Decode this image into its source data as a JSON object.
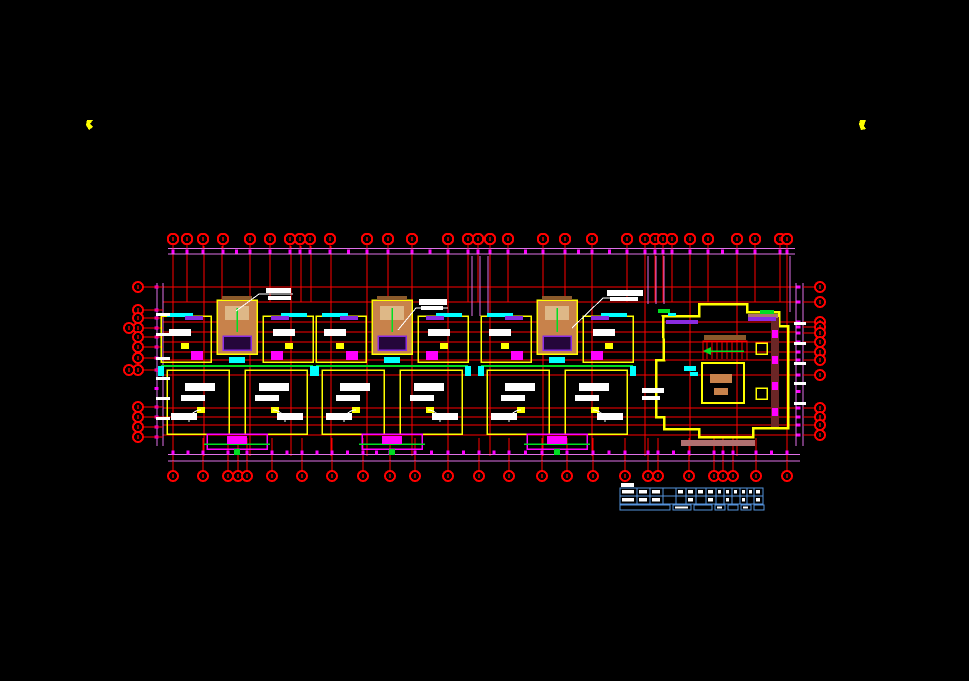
{
  "meta": {
    "width": 969,
    "height": 681,
    "background": "#000000",
    "drawing_type": "residential-floor-plan"
  },
  "colors": {
    "grid": "#ff0000",
    "grid_dark": "#aa0000",
    "dim": "#ff00ff",
    "dim2": "#e070e8",
    "wall": "#ffff00",
    "core": "#c8824b",
    "core2": "#deb887",
    "cyan": "#00ffff",
    "green": "#00dd22",
    "purple": "#8a2be2",
    "white": "#ffffff",
    "brown": "#8b5a2b",
    "rose": "#b07070",
    "darkred": "#6b2626",
    "table": "#5593dd",
    "black": "#000000"
  },
  "markers": [
    {
      "pts": [
        [
          87,
          120
        ],
        [
          93,
          120
        ],
        [
          90,
          124
        ],
        [
          93,
          127
        ],
        [
          89,
          130
        ],
        [
          86,
          125
        ]
      ]
    },
    {
      "pts": [
        [
          860,
          120
        ],
        [
          866,
          120
        ],
        [
          864,
          126
        ],
        [
          866,
          129
        ],
        [
          861,
          130
        ],
        [
          859,
          124
        ]
      ]
    }
  ],
  "top_chain": {
    "x1": 168,
    "x2": 795,
    "line_y": [
      248.5,
      254
    ],
    "tick_y": 249.5,
    "bubble_cy": 239,
    "bubble_r": 5.2,
    "bubbles_x": [
      173,
      187,
      203,
      223,
      250,
      270,
      290,
      300,
      310,
      330,
      367,
      388,
      412,
      448,
      468,
      478,
      490,
      508,
      543,
      565,
      592,
      627,
      645,
      655,
      663,
      672,
      690,
      708,
      737,
      755,
      780,
      787
    ]
  },
  "bottom_chain": {
    "x1": 168,
    "x2": 800,
    "line_y": [
      454.5,
      461
    ],
    "tick_y": 450.5,
    "bubble_cy": 476,
    "bubble_r": 5,
    "bubbles_x": [
      173,
      203,
      228,
      238,
      247,
      272,
      302,
      332,
      363,
      390,
      415,
      448,
      479,
      509,
      542,
      567,
      593,
      625,
      648,
      658,
      689,
      714,
      723,
      733,
      756,
      787
    ]
  },
  "left_chain": {
    "y1": 283,
    "y2": 446,
    "line_x": [
      157,
      163
    ],
    "tick_x": 154.5,
    "bubble_cx": 138,
    "bubble_r": 5,
    "bubbles_y": [
      287,
      310,
      318,
      328,
      337,
      347,
      358,
      370,
      407,
      417,
      427,
      437
    ],
    "double_y": [
      328,
      370
    ]
  },
  "right_chain": {
    "y1": 283,
    "y2": 446,
    "line_x": [
      796,
      803
    ],
    "tick_x": 796.5,
    "bubble_cx": 820,
    "bubble_r": 5,
    "bubbles_y": [
      287,
      302,
      322,
      327,
      333,
      342,
      352,
      360,
      375,
      408,
      417,
      425,
      435
    ],
    "double_y": []
  },
  "grid": {
    "verticals_full": [
      173,
      204,
      250,
      291,
      331,
      367,
      412,
      448,
      490,
      543,
      592,
      645,
      690,
      737,
      787
    ],
    "vert_y1": 246,
    "vert_y2": 456,
    "verticals_short": [
      187,
      222,
      270,
      301,
      311,
      388,
      468,
      478,
      508,
      565,
      627,
      655,
      663,
      672,
      708,
      755,
      780
    ],
    "short_y2": 302,
    "horizontal_x1": 163,
    "horizontal_x2": 800,
    "horizontals_y": [
      287,
      302,
      322,
      332,
      342,
      352,
      360,
      375,
      408,
      417,
      425,
      435
    ],
    "stem_y1": 438,
    "stem_y2": 471
  },
  "dim_stubs": [
    {
      "x": 472,
      "y1": 256,
      "y2": 316
    },
    {
      "x": 480,
      "y1": 256,
      "y2": 316
    },
    {
      "x": 488,
      "y1": 256,
      "y2": 316
    },
    {
      "x": 648,
      "y1": 256,
      "y2": 304
    },
    {
      "x": 656,
      "y1": 256,
      "y2": 304
    },
    {
      "x": 664,
      "y1": 256,
      "y2": 304
    },
    {
      "x": 790,
      "y1": 256,
      "y2": 312
    }
  ],
  "white_ticks": {
    "left": {
      "x": 156,
      "w": 14,
      "h": 3,
      "ys": [
        313,
        333,
        357,
        377,
        397,
        417
      ]
    },
    "right": {
      "x": 794,
      "w": 12,
      "h": 3,
      "ys": [
        322,
        342,
        362,
        382,
        402
      ]
    }
  },
  "units": {
    "centers": [
      237,
      392,
      557
    ],
    "prims": [
      {
        "t": "rect",
        "dx": -76,
        "y": 316,
        "w": 50,
        "h": 46,
        "s": "wall",
        "lw": 1.5
      },
      {
        "t": "rect",
        "dx": 26,
        "y": 316,
        "w": 50,
        "h": 46,
        "s": "wall",
        "lw": 1.5
      },
      {
        "t": "rect",
        "dx": -70,
        "y": 370,
        "w": 62,
        "h": 64,
        "s": "wall",
        "lw": 1.5
      },
      {
        "t": "rect",
        "dx": 8,
        "y": 370,
        "w": 62,
        "h": 64,
        "s": "wall",
        "lw": 1.5
      },
      {
        "t": "rect",
        "dx": -20,
        "y": 300,
        "w": 40,
        "h": 54,
        "f": "core",
        "s": "wall",
        "lw": 1.5
      },
      {
        "t": "rect",
        "dx": -12,
        "y": 306,
        "w": 24,
        "h": 14,
        "f": "core2"
      },
      {
        "t": "line",
        "x1d": 0,
        "y1": 308,
        "x2d": 0,
        "y2": 332,
        "s": "green",
        "lw": 1.5
      },
      {
        "t": "rect",
        "dx": -14,
        "y": 336,
        "w": 28,
        "h": 14,
        "f": "#24063a",
        "s": "purple",
        "lw": 1.5
      },
      {
        "t": "rect",
        "dx": -15,
        "y": 296,
        "w": 30,
        "h": 4,
        "f": "brown"
      },
      {
        "t": "rect",
        "dx": -70,
        "y": 313,
        "w": 26,
        "h": 4,
        "f": "cyan"
      },
      {
        "t": "rect",
        "dx": 44,
        "y": 313,
        "w": 26,
        "h": 4,
        "f": "cyan"
      },
      {
        "t": "rect",
        "dx": -52,
        "y": 316,
        "w": 18,
        "h": 4,
        "f": "purple"
      },
      {
        "t": "rect",
        "dx": 34,
        "y": 316,
        "w": 18,
        "h": 4,
        "f": "purple"
      },
      {
        "t": "rect",
        "dx": -68,
        "y": 329,
        "w": 22,
        "h": 7,
        "f": "white"
      },
      {
        "t": "rect",
        "dx": 36,
        "y": 329,
        "w": 22,
        "h": 7,
        "f": "white"
      },
      {
        "t": "rect",
        "dx": -56,
        "y": 343,
        "w": 8,
        "h": 6,
        "f": "wall"
      },
      {
        "t": "rect",
        "dx": 48,
        "y": 343,
        "w": 8,
        "h": 6,
        "f": "wall"
      },
      {
        "t": "rect",
        "dx": -46,
        "y": 351,
        "w": 12,
        "h": 9,
        "f": "dim"
      },
      {
        "t": "rect",
        "dx": 34,
        "y": 351,
        "w": 12,
        "h": 9,
        "f": "dim"
      },
      {
        "t": "line",
        "x1d": -76,
        "y1": 366,
        "x2d": 76,
        "y2": 366,
        "s": "green",
        "lw": 2
      },
      {
        "t": "rect",
        "dx": -8,
        "y": 357,
        "w": 16,
        "h": 6,
        "f": "cyan"
      },
      {
        "t": "rect",
        "dx": -52,
        "y": 383,
        "w": 30,
        "h": 8,
        "f": "white"
      },
      {
        "t": "rect",
        "dx": -56,
        "y": 395,
        "w": 24,
        "h": 6,
        "f": "white"
      },
      {
        "t": "rect",
        "dx": 22,
        "y": 383,
        "w": 30,
        "h": 8,
        "f": "white"
      },
      {
        "t": "rect",
        "dx": 18,
        "y": 395,
        "w": 24,
        "h": 6,
        "f": "white"
      },
      {
        "t": "rect",
        "dx": -40,
        "y": 407,
        "w": 8,
        "h": 6,
        "f": "wall"
      },
      {
        "t": "rect",
        "dx": 34,
        "y": 407,
        "w": 8,
        "h": 6,
        "f": "wall"
      },
      {
        "t": "rect",
        "dx": -66,
        "y": 413,
        "w": 26,
        "h": 7,
        "f": "white"
      },
      {
        "t": "rect",
        "dx": 40,
        "y": 413,
        "w": 26,
        "h": 7,
        "f": "white"
      },
      {
        "t": "rect",
        "dx": -30,
        "y": 434,
        "w": 60,
        "h": 15,
        "s": "dim",
        "lw": 1.5
      },
      {
        "t": "line",
        "x1d": -33,
        "y1": 444,
        "x2d": 33,
        "y2": 444,
        "s": "green",
        "lw": 1.5
      },
      {
        "t": "rect",
        "dx": -10,
        "y": 436,
        "w": 20,
        "h": 8,
        "f": "dim"
      },
      {
        "t": "rect",
        "dx": -3,
        "y": 449,
        "w": 6,
        "h": 6,
        "f": "green"
      },
      {
        "t": "rect",
        "dx": -79,
        "y": 366,
        "w": 6,
        "h": 10,
        "f": "cyan"
      },
      {
        "t": "rect",
        "dx": 73,
        "y": 366,
        "w": 6,
        "h": 10,
        "f": "cyan"
      },
      {
        "t": "arc",
        "dx": -36,
        "y": 422,
        "r": 12,
        "dir": 1
      },
      {
        "t": "arc",
        "dx": 36,
        "y": 422,
        "r": 12,
        "dir": -1
      }
    ]
  },
  "right_room": {
    "outline": [
      [
        663,
        316
      ],
      [
        699,
        316
      ],
      [
        699,
        304
      ],
      [
        747,
        304
      ],
      [
        747,
        312
      ],
      [
        779,
        312
      ],
      [
        779,
        326
      ],
      [
        788,
        326
      ],
      [
        788,
        428
      ],
      [
        753,
        428
      ],
      [
        753,
        437
      ],
      [
        699,
        437
      ],
      [
        699,
        429
      ],
      [
        664,
        429
      ],
      [
        664,
        417
      ],
      [
        656,
        417
      ],
      [
        656,
        360
      ],
      [
        664,
        360
      ]
    ],
    "outline_lw": 2.5,
    "prims": [
      {
        "t": "rect",
        "x": 704,
        "y": 335,
        "w": 42,
        "h": 5,
        "f": "brown"
      },
      {
        "t": "rect",
        "x": 703,
        "y": 341,
        "w": 44,
        "h": 19,
        "s": "grid",
        "lw": 1
      },
      {
        "t": "hatchv",
        "x": 707,
        "y": 342,
        "w": 38,
        "h": 17,
        "step": 5,
        "s": "grid"
      },
      {
        "t": "line",
        "x1": 708,
        "y1": 351,
        "x2": 744,
        "y2": 351,
        "s": "green",
        "lw": 1.5
      },
      {
        "t": "poly",
        "pts": [
          [
            703,
            351
          ],
          [
            711,
            347
          ],
          [
            711,
            355
          ]
        ],
        "f": "green"
      },
      {
        "t": "rect",
        "x": 702,
        "y": 363,
        "w": 42,
        "h": 40,
        "s": "wall",
        "lw": 2
      },
      {
        "t": "rect",
        "x": 710,
        "y": 374,
        "w": 22,
        "h": 9,
        "f": "core"
      },
      {
        "t": "rect",
        "x": 714,
        "y": 388,
        "w": 14,
        "h": 7,
        "f": "core"
      },
      {
        "t": "rect",
        "x": 756,
        "y": 343,
        "w": 11,
        "h": 11,
        "s": "wall",
        "lw": 1.5
      },
      {
        "t": "rect",
        "x": 756,
        "y": 388,
        "w": 11,
        "h": 11,
        "s": "wall",
        "lw": 1.5
      },
      {
        "t": "rect",
        "x": 771,
        "y": 317,
        "w": 8,
        "h": 110,
        "f": "darkred"
      },
      {
        "t": "rect",
        "x": 772,
        "y": 330,
        "w": 6,
        "h": 8,
        "f": "dim"
      },
      {
        "t": "rect",
        "x": 772,
        "y": 356,
        "w": 6,
        "h": 8,
        "f": "dim"
      },
      {
        "t": "rect",
        "x": 772,
        "y": 382,
        "w": 6,
        "h": 8,
        "f": "dim"
      },
      {
        "t": "rect",
        "x": 772,
        "y": 408,
        "w": 6,
        "h": 8,
        "f": "dim"
      },
      {
        "t": "rect",
        "x": 681,
        "y": 440,
        "w": 74,
        "h": 6,
        "f": "rose"
      },
      {
        "t": "rect",
        "x": 748,
        "y": 314,
        "w": 30,
        "h": 4,
        "f": "rose"
      },
      {
        "t": "rect",
        "x": 658,
        "y": 309,
        "w": 12,
        "h": 4,
        "f": "green"
      },
      {
        "t": "rect",
        "x": 760,
        "y": 310,
        "w": 14,
        "h": 4,
        "f": "green"
      },
      {
        "t": "rect",
        "x": 668,
        "y": 313,
        "w": 8,
        "h": 3,
        "f": "cyan"
      },
      {
        "t": "rect",
        "x": 666,
        "y": 320,
        "w": 32,
        "h": 4,
        "f": "purple"
      },
      {
        "t": "rect",
        "x": 748,
        "y": 317,
        "w": 28,
        "h": 4,
        "f": "purple"
      },
      {
        "t": "rect",
        "x": 684,
        "y": 366,
        "w": 12,
        "h": 5,
        "f": "cyan"
      },
      {
        "t": "rect",
        "x": 690,
        "y": 372,
        "w": 8,
        "h": 4,
        "f": "cyan"
      },
      {
        "t": "rect",
        "x": 642,
        "y": 388,
        "w": 22,
        "h": 5,
        "f": "white"
      },
      {
        "t": "rect",
        "x": 642,
        "y": 396,
        "w": 18,
        "h": 4,
        "f": "white"
      }
    ]
  },
  "annotations": [
    {
      "points": [
        [
          236,
          311
        ],
        [
          259,
          294
        ],
        [
          293,
          294
        ]
      ],
      "blocks": [
        [
          266,
          288,
          25,
          5
        ],
        [
          268,
          296,
          23,
          4
        ]
      ]
    },
    {
      "points": [
        [
          398,
          330
        ],
        [
          416,
          308
        ],
        [
          448,
          308
        ]
      ],
      "blocks": [
        [
          419,
          299,
          28,
          6
        ],
        [
          421,
          306,
          22,
          4
        ]
      ]
    },
    {
      "points": [
        [
          572,
          328
        ],
        [
          603,
          298
        ],
        [
          636,
          298
        ]
      ],
      "blocks": [
        [
          607,
          290,
          36,
          6
        ],
        [
          610,
          297,
          28,
          4
        ]
      ]
    }
  ],
  "table": {
    "x": 620,
    "y": 488,
    "row_heights": [
      8,
      8
    ],
    "col_widths": [
      17,
      13,
      13,
      13,
      10,
      10,
      10,
      10,
      8,
      8,
      8,
      7,
      7,
      9
    ],
    "label_block": [
      621,
      483,
      13,
      4
    ],
    "row1_blocks": [
      0,
      1,
      2,
      4,
      5,
      6,
      7,
      8,
      9,
      10,
      11,
      12,
      13
    ],
    "row2_blocks": [
      0,
      1,
      2,
      5,
      7,
      9,
      11,
      13
    ],
    "band": {
      "y": 505,
      "h": 5,
      "segments": [
        [
          620,
          50
        ],
        [
          673,
          18
        ],
        [
          694,
          18
        ],
        [
          715,
          10
        ],
        [
          728,
          10
        ],
        [
          741,
          10
        ],
        [
          754,
          10
        ]
      ],
      "dash_segments": [
        1,
        3,
        5
      ]
    }
  }
}
